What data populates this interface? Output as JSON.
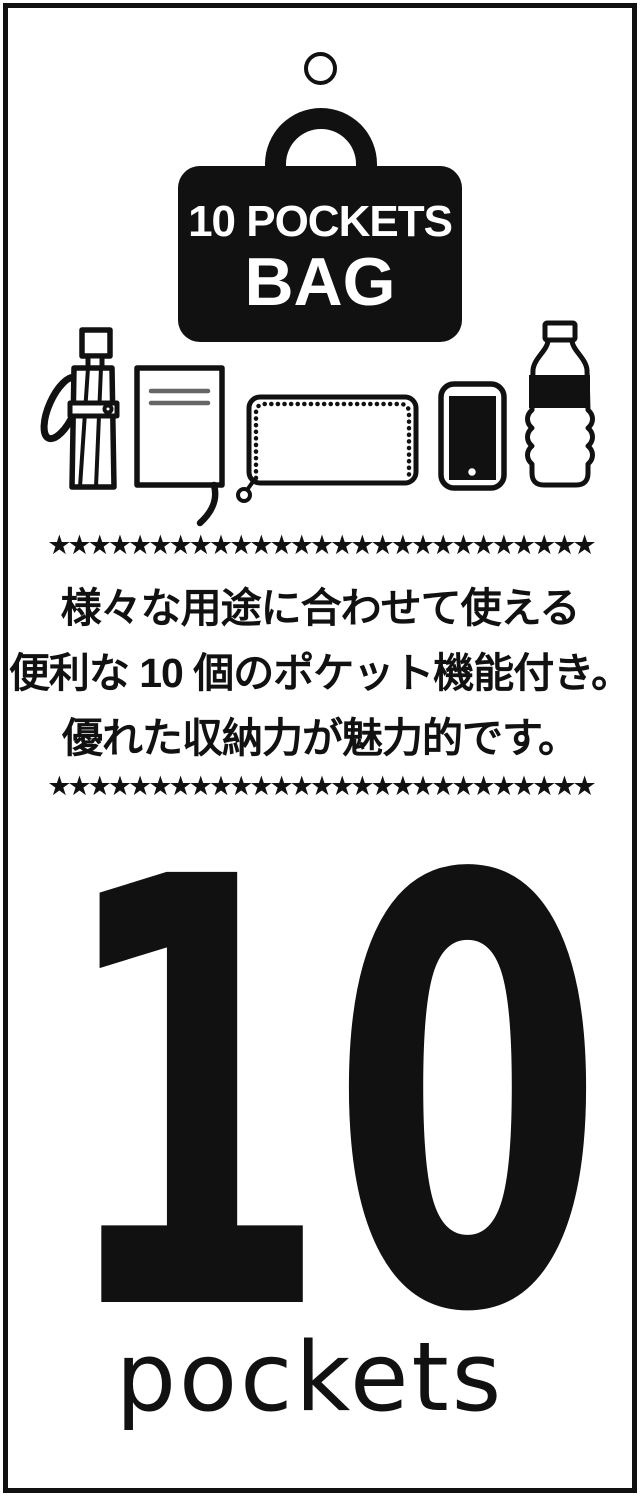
{
  "tag": {
    "badge": {
      "title": "10 POCKETS",
      "subtitle": "BAG"
    },
    "stars": {
      "row": "★★★★★★★★★★★★★★★★★★★★★★★★★★★"
    },
    "description": {
      "line1": "様々な用途に合わせて使える",
      "line2": "便利な 10 個のポケット機能付き。",
      "line3": "優れた収納力が魅力的です。"
    },
    "feature": {
      "number": "10",
      "label": "pockets"
    },
    "icons": [
      "umbrella-icon",
      "notebook-icon",
      "wallet-icon",
      "smartphone-icon",
      "bottle-icon"
    ],
    "colors": {
      "ink": "#111111",
      "background": "#ffffff"
    }
  }
}
